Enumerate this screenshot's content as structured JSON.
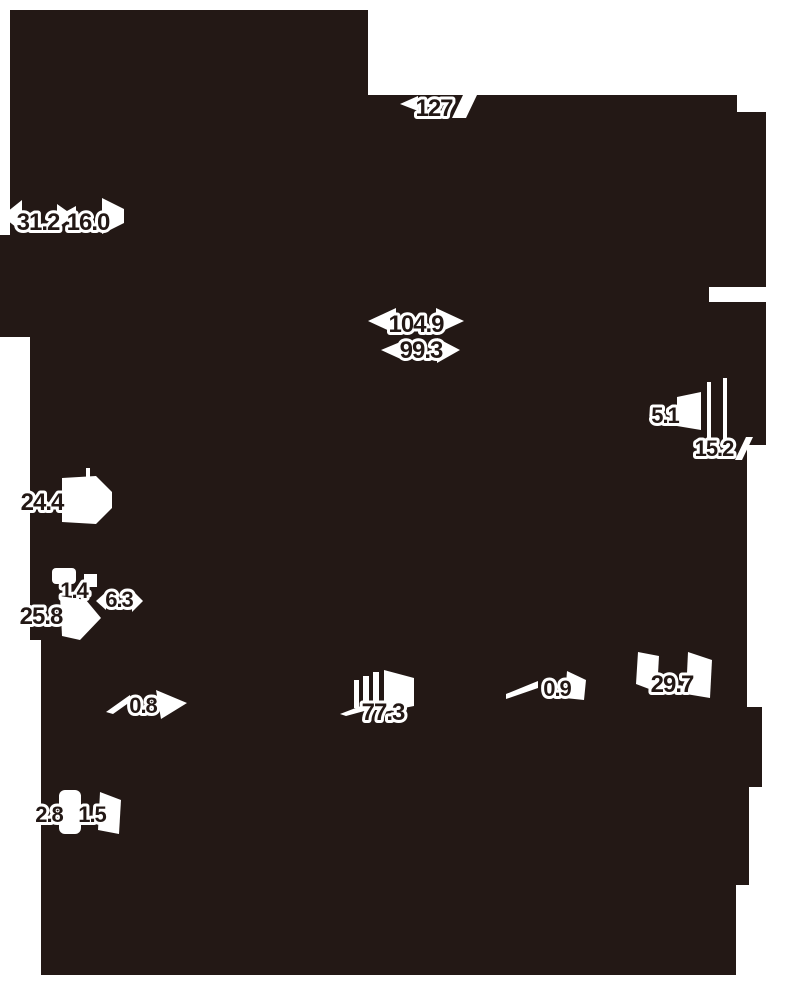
{
  "drawing": {
    "kind": "dimension-silhouette-diagram",
    "colors": {
      "ink": "#231815",
      "paper": "#ffffff",
      "label_text": "#231815",
      "label_halo": "#ffffff"
    }
  },
  "labels": [
    {
      "id": "dim-127",
      "text": "127"
    },
    {
      "id": "dim-31-2",
      "text": "31.2"
    },
    {
      "id": "dim-16-0",
      "text": "16.0"
    },
    {
      "id": "dim-104-9",
      "text": "104.9"
    },
    {
      "id": "dim-99-3",
      "text": "99.3"
    },
    {
      "id": "dim-5-1",
      "text": "5.1"
    },
    {
      "id": "dim-15-2",
      "text": "15.2"
    },
    {
      "id": "dim-24-4",
      "text": "24.4"
    },
    {
      "id": "dim-1-4",
      "text": "1.4"
    },
    {
      "id": "dim-6-3",
      "text": "6.3"
    },
    {
      "id": "dim-25-8",
      "text": "25.8"
    },
    {
      "id": "dim-0-8",
      "text": "0.8"
    },
    {
      "id": "dim-77-3",
      "text": "77.3"
    },
    {
      "id": "dim-0-9",
      "text": "0.9"
    },
    {
      "id": "dim-29-7",
      "text": "29.7"
    },
    {
      "id": "dim-2-8",
      "text": "2.8"
    },
    {
      "id": "dim-1-5",
      "text": "1.5"
    }
  ]
}
